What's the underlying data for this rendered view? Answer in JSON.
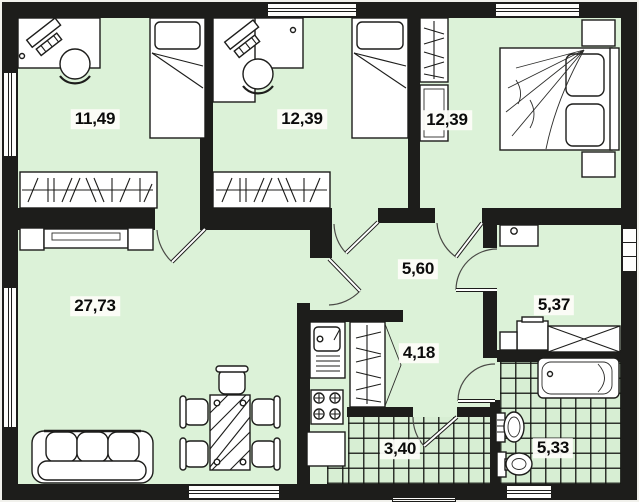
{
  "plan": {
    "title": "apartment floor plan",
    "rooms": [
      {
        "name": "bedroom-top-left",
        "area": "11,49"
      },
      {
        "name": "bedroom-top-middle",
        "area": "12,39"
      },
      {
        "name": "bedroom-top-right",
        "area": "12,39"
      },
      {
        "name": "hallway",
        "area": "5,60"
      },
      {
        "name": "living-room",
        "area": "27,73"
      },
      {
        "name": "bathroom",
        "area": "5,37"
      },
      {
        "name": "kitchen-niche",
        "area": "4,18"
      },
      {
        "name": "entry-hall",
        "area": "3,40"
      },
      {
        "name": "wc",
        "area": "5,33"
      }
    ],
    "colors": {
      "floor": "#dcf2d8",
      "wall": "#1d1d1b",
      "furniture": "#ffffff",
      "background": "#f1f1ec",
      "label_bg": "#fcfcf8",
      "label_text": "#0b0b0b"
    }
  }
}
